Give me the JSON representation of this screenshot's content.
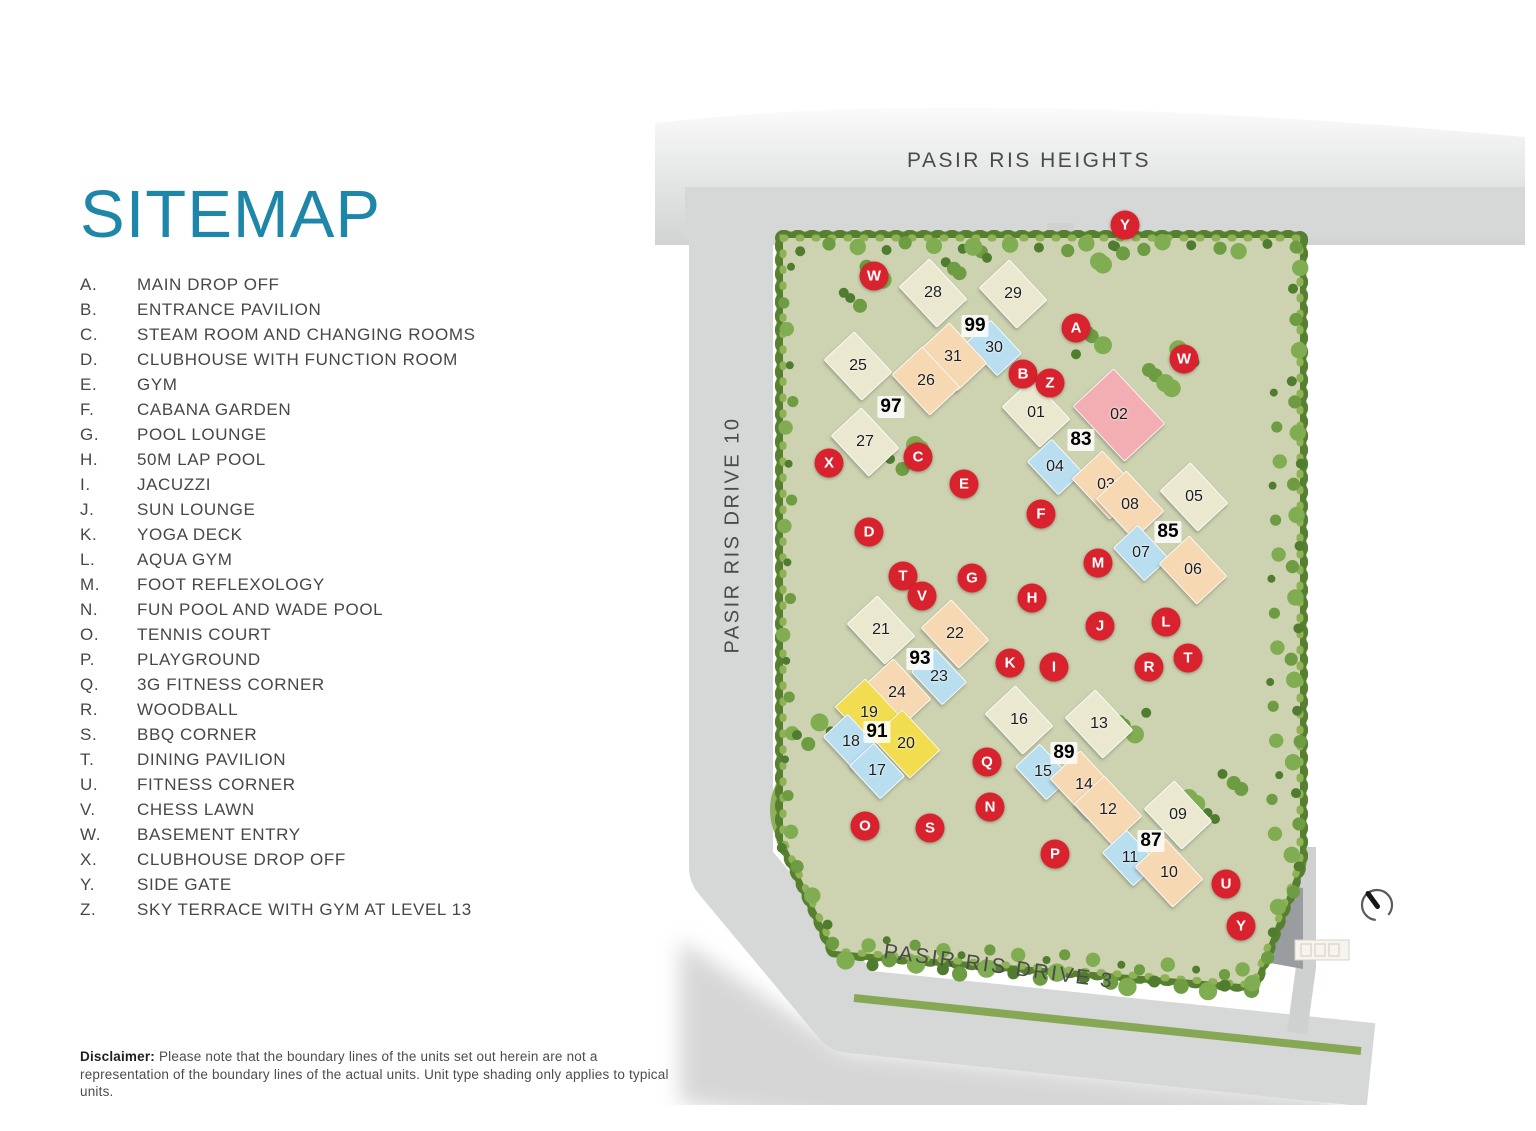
{
  "title": "SITEMAP",
  "legend": [
    {
      "key": "A.",
      "label": "MAIN DROP OFF"
    },
    {
      "key": "B.",
      "label": "ENTRANCE PAVILION"
    },
    {
      "key": "C.",
      "label": "STEAM ROOM AND CHANGING ROOMS"
    },
    {
      "key": "D.",
      "label": "CLUBHOUSE WITH FUNCTION ROOM"
    },
    {
      "key": "E.",
      "label": "GYM"
    },
    {
      "key": "F.",
      "label": "CABANA GARDEN"
    },
    {
      "key": "G.",
      "label": "POOL LOUNGE"
    },
    {
      "key": "H.",
      "label": "50M LAP POOL"
    },
    {
      "key": "I.",
      "label": "JACUZZI"
    },
    {
      "key": "J.",
      "label": "SUN LOUNGE"
    },
    {
      "key": "K.",
      "label": "YOGA DECK"
    },
    {
      "key": "L.",
      "label": "AQUA GYM"
    },
    {
      "key": "M.",
      "label": "FOOT REFLEXOLOGY"
    },
    {
      "key": "N.",
      "label": "FUN POOL AND WADE POOL"
    },
    {
      "key": "O.",
      "label": "TENNIS COURT"
    },
    {
      "key": "P.",
      "label": "PLAYGROUND"
    },
    {
      "key": "Q.",
      "label": "3G FITNESS CORNER"
    },
    {
      "key": "R.",
      "label": "WOODBALL"
    },
    {
      "key": "S.",
      "label": "BBQ CORNER"
    },
    {
      "key": "T.",
      "label": "DINING PAVILION"
    },
    {
      "key": "U.",
      "label": "FITNESS CORNER"
    },
    {
      "key": "V.",
      "label": "CHESS LAWN"
    },
    {
      "key": "W.",
      "label": "BASEMENT ENTRY"
    },
    {
      "key": "X.",
      "label": "CLUBHOUSE DROP OFF"
    },
    {
      "key": "Y.",
      "label": "SIDE GATE"
    },
    {
      "key": "Z.",
      "label": "SKY TERRACE WITH GYM AT LEVEL 13"
    }
  ],
  "map": {
    "road_labels": {
      "top": "PASIR RIS HEIGHTS",
      "left": "PASIR RIS DRIVE 10",
      "bottom": "PASIR RIS DRIVE 3"
    },
    "colors": {
      "marker": "#d8232e",
      "cream": "#eae8ce",
      "peach": "#f6d8b2",
      "yellow": "#f1dd4f",
      "blue": "#b8def0",
      "pink": "#f2aeb2",
      "pool": "#4f88ad",
      "hedge": "#6d9440",
      "road": "#d6d7d7",
      "title": "#1e87a9"
    },
    "markers": [
      {
        "letter": "Y",
        "x": 470,
        "y": 130
      },
      {
        "letter": "W",
        "x": 219,
        "y": 181
      },
      {
        "letter": "A",
        "x": 421,
        "y": 233
      },
      {
        "letter": "W",
        "x": 529,
        "y": 264
      },
      {
        "letter": "B",
        "x": 368,
        "y": 279
      },
      {
        "letter": "Z",
        "x": 395,
        "y": 288
      },
      {
        "letter": "X",
        "x": 174,
        "y": 368
      },
      {
        "letter": "C",
        "x": 263,
        "y": 362
      },
      {
        "letter": "E",
        "x": 309,
        "y": 389
      },
      {
        "letter": "D",
        "x": 214,
        "y": 437
      },
      {
        "letter": "F",
        "x": 386,
        "y": 419
      },
      {
        "letter": "T",
        "x": 248,
        "y": 481
      },
      {
        "letter": "V",
        "x": 267,
        "y": 501
      },
      {
        "letter": "G",
        "x": 317,
        "y": 483
      },
      {
        "letter": "H",
        "x": 377,
        "y": 503
      },
      {
        "letter": "M",
        "x": 443,
        "y": 468
      },
      {
        "letter": "J",
        "x": 445,
        "y": 531
      },
      {
        "letter": "L",
        "x": 511,
        "y": 527
      },
      {
        "letter": "K",
        "x": 355,
        "y": 568
      },
      {
        "letter": "I",
        "x": 399,
        "y": 572
      },
      {
        "letter": "R",
        "x": 494,
        "y": 572
      },
      {
        "letter": "T",
        "x": 533,
        "y": 563
      },
      {
        "letter": "Q",
        "x": 332,
        "y": 667
      },
      {
        "letter": "N",
        "x": 335,
        "y": 712
      },
      {
        "letter": "O",
        "x": 210,
        "y": 731
      },
      {
        "letter": "S",
        "x": 275,
        "y": 733
      },
      {
        "letter": "P",
        "x": 400,
        "y": 759
      },
      {
        "letter": "U",
        "x": 571,
        "y": 789
      },
      {
        "letter": "Y",
        "x": 586,
        "y": 831
      }
    ],
    "blocks": [
      {
        "num": "28",
        "x": 278,
        "y": 198,
        "type": "cream"
      },
      {
        "num": "29",
        "x": 358,
        "y": 199,
        "type": "cream"
      },
      {
        "num": "30",
        "x": 339,
        "y": 253,
        "type": "blue"
      },
      {
        "num": "31",
        "x": 298,
        "y": 262,
        "type": "peach"
      },
      {
        "num": "25",
        "x": 203,
        "y": 271,
        "type": "cream"
      },
      {
        "num": "26",
        "x": 271,
        "y": 286,
        "type": "peach"
      },
      {
        "num": "27",
        "x": 210,
        "y": 347,
        "type": "cream"
      },
      {
        "num": "01",
        "x": 381,
        "y": 318,
        "type": "cream"
      },
      {
        "num": "02",
        "x": 464,
        "y": 320,
        "type": "pink"
      },
      {
        "num": "04",
        "x": 400,
        "y": 372,
        "type": "blue"
      },
      {
        "num": "03",
        "x": 451,
        "y": 390,
        "type": "peach"
      },
      {
        "num": "08",
        "x": 475,
        "y": 410,
        "type": "peach"
      },
      {
        "num": "05",
        "x": 539,
        "y": 402,
        "type": "cream"
      },
      {
        "num": "07",
        "x": 486,
        "y": 458,
        "type": "blue"
      },
      {
        "num": "06",
        "x": 538,
        "y": 475,
        "type": "peach"
      },
      {
        "num": "21",
        "x": 226,
        "y": 535,
        "type": "cream"
      },
      {
        "num": "22",
        "x": 300,
        "y": 539,
        "type": "peach"
      },
      {
        "num": "23",
        "x": 284,
        "y": 582,
        "type": "blue"
      },
      {
        "num": "24",
        "x": 242,
        "y": 598,
        "type": "peach"
      },
      {
        "num": "19",
        "x": 214,
        "y": 618,
        "type": "yellow"
      },
      {
        "num": "18",
        "x": 196,
        "y": 647,
        "type": "blue"
      },
      {
        "num": "20",
        "x": 251,
        "y": 649,
        "type": "yellow"
      },
      {
        "num": "17",
        "x": 222,
        "y": 676,
        "type": "blue"
      },
      {
        "num": "16",
        "x": 364,
        "y": 625,
        "type": "cream"
      },
      {
        "num": "15",
        "x": 388,
        "y": 677,
        "type": "blue"
      },
      {
        "num": "13",
        "x": 444,
        "y": 629,
        "type": "cream"
      },
      {
        "num": "14",
        "x": 429,
        "y": 690,
        "type": "peach"
      },
      {
        "num": "12",
        "x": 453,
        "y": 715,
        "type": "peach"
      },
      {
        "num": "09",
        "x": 523,
        "y": 720,
        "type": "cream"
      },
      {
        "num": "11",
        "x": 475,
        "y": 763,
        "type": "blue"
      },
      {
        "num": "10",
        "x": 514,
        "y": 778,
        "type": "peach"
      }
    ],
    "addresses": [
      {
        "num": "99",
        "x": 320,
        "y": 231
      },
      {
        "num": "97",
        "x": 236,
        "y": 312
      },
      {
        "num": "83",
        "x": 426,
        "y": 345
      },
      {
        "num": "85",
        "x": 513,
        "y": 437
      },
      {
        "num": "93",
        "x": 265,
        "y": 564
      },
      {
        "num": "91",
        "x": 222,
        "y": 637
      },
      {
        "num": "89",
        "x": 409,
        "y": 658
      },
      {
        "num": "87",
        "x": 496,
        "y": 746
      }
    ]
  },
  "disclaimer": {
    "label": "Disclaimer:",
    "text": "Please note that the boundary lines of the units set out herein are not a representation of the boundary lines of the actual units. Unit type shading only applies to typical units."
  }
}
